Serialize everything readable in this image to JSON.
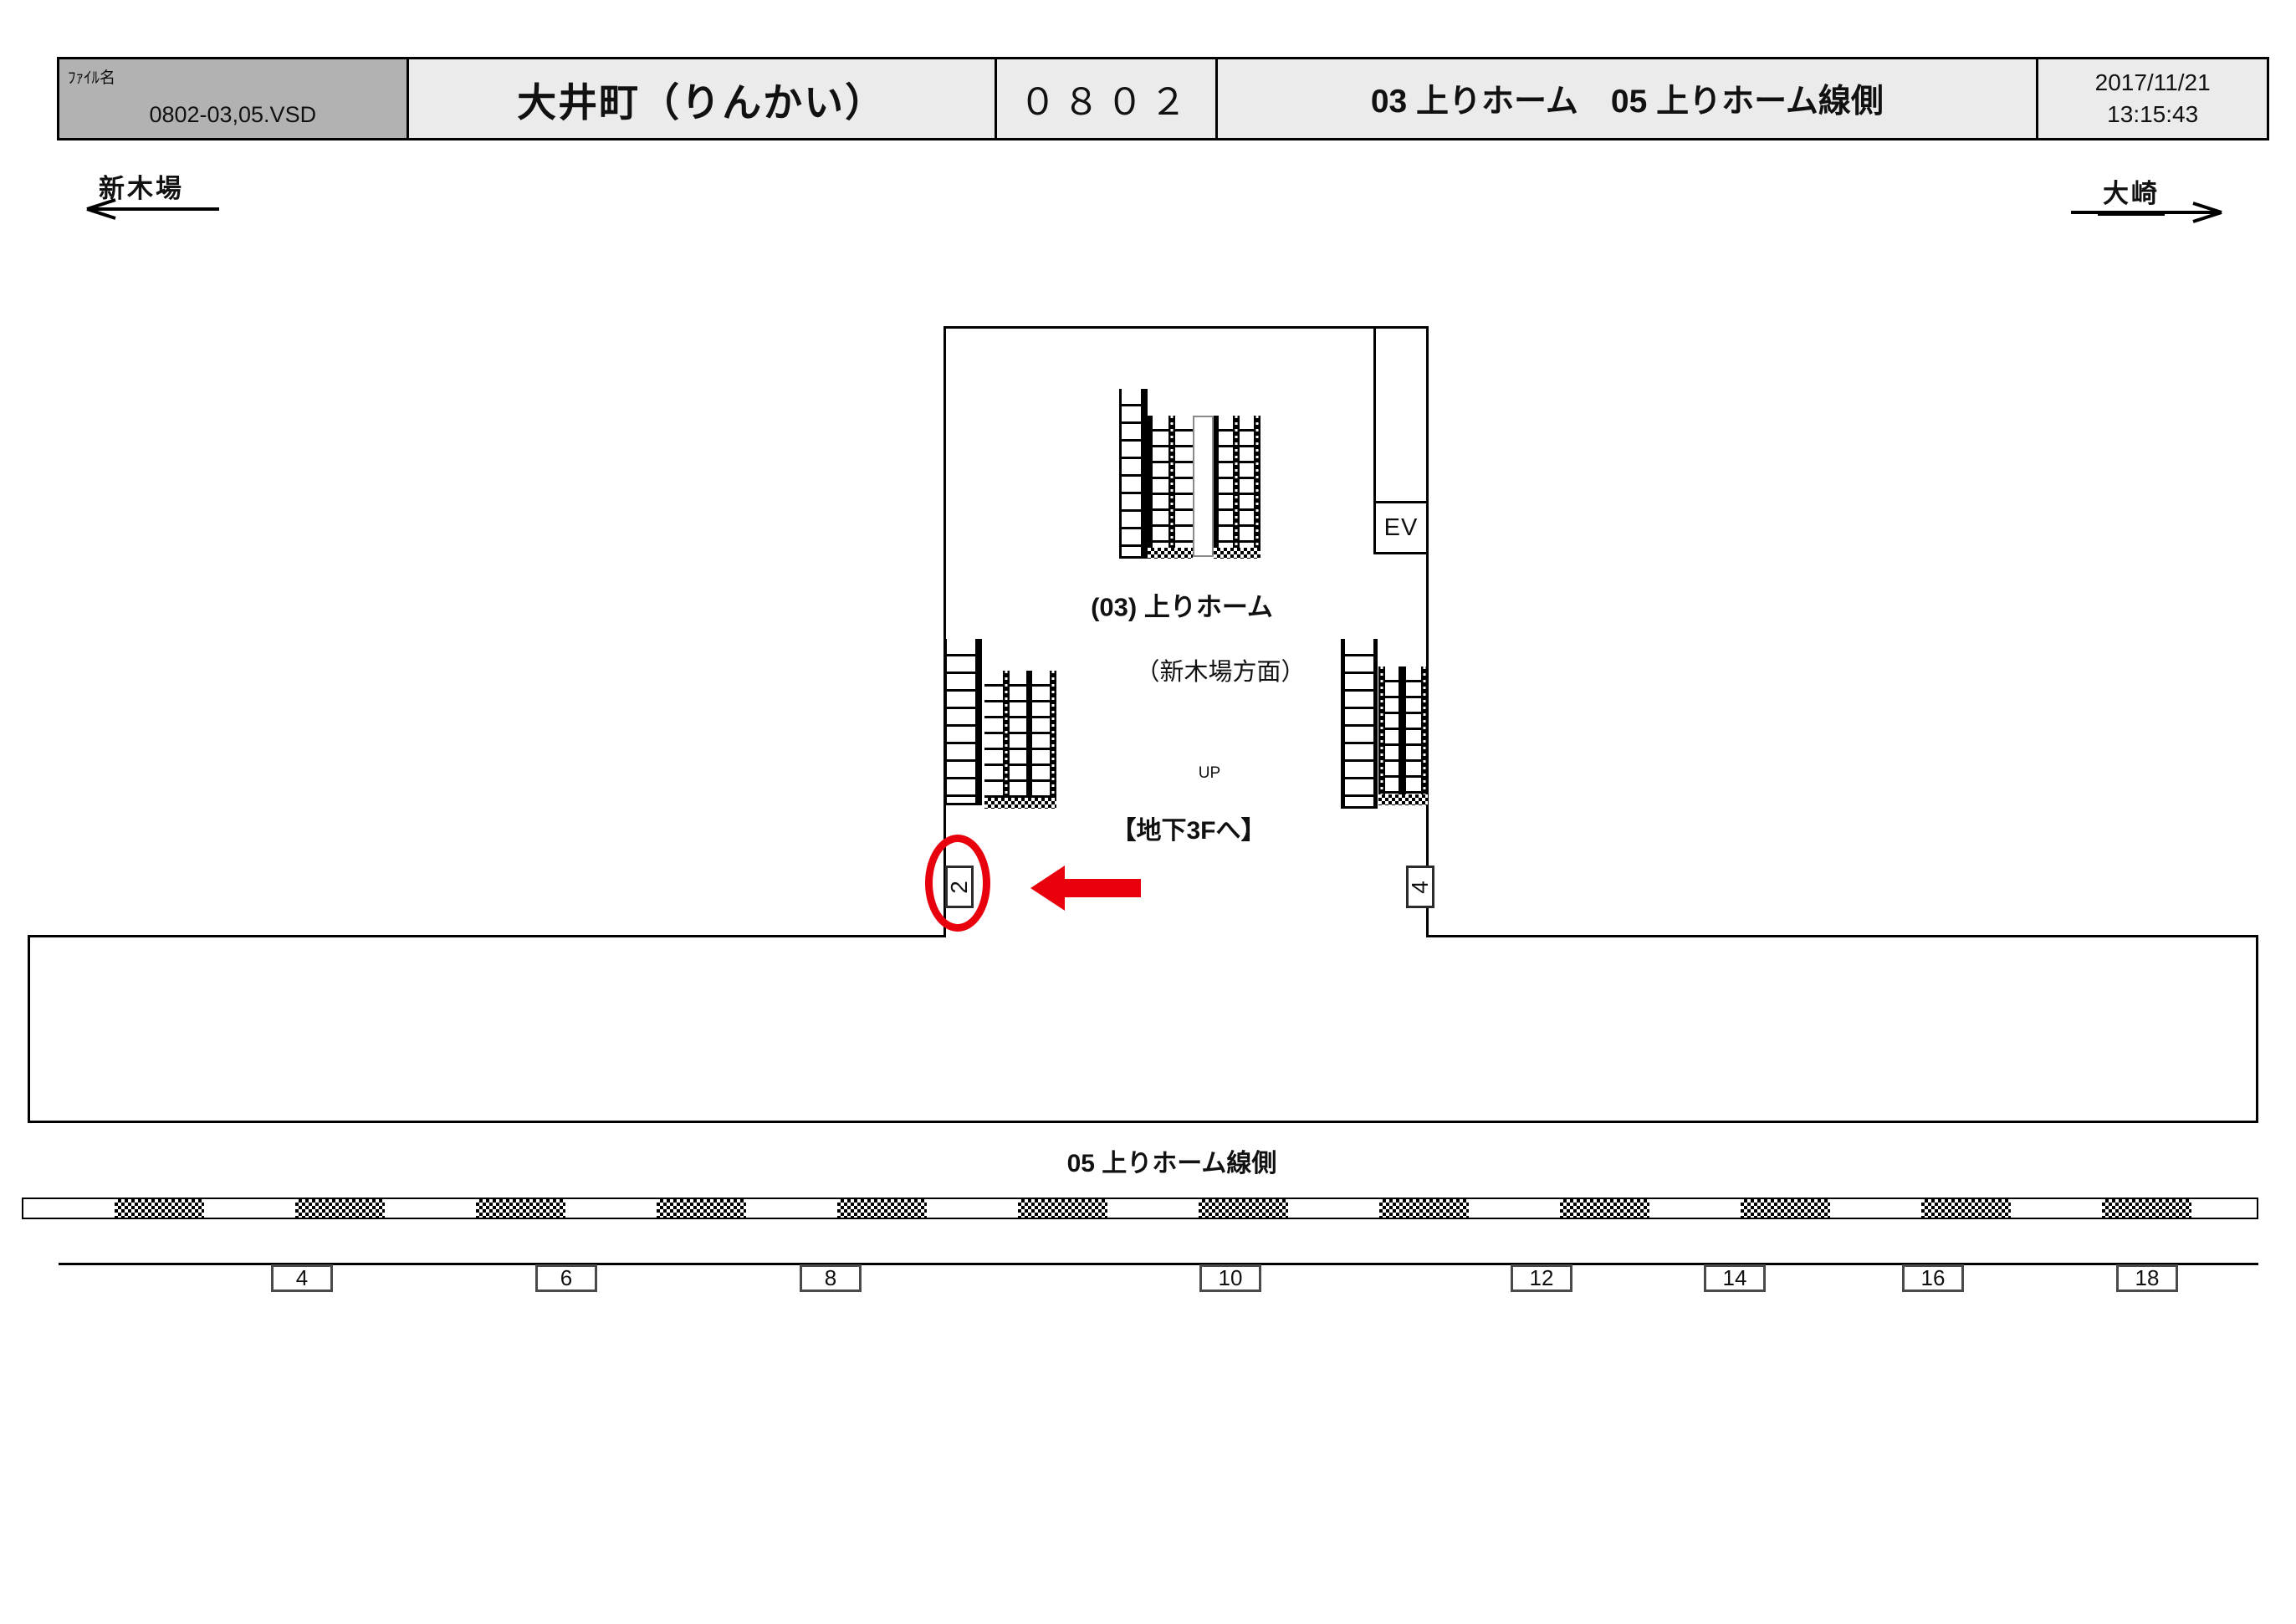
{
  "header": {
    "file_label": "ﾌｧｲﾙ名",
    "file_name": "0802-03,05.VSD",
    "station_name": "大井町（りんかい）",
    "station_code": "０８０２",
    "sheet_title": "03 上りホーム　05 上りホーム線側",
    "date": "2017/11/21",
    "time": "13:15:43"
  },
  "directions": {
    "left": "新木場",
    "right": "大崎"
  },
  "concourse": {
    "elevator": "EV",
    "floor_label": "(03) 上りホーム",
    "direction_note": "（新木場方面）",
    "up": "UP",
    "basement_note": "【地下3Fへ】",
    "left_position": "2",
    "right_position": "4"
  },
  "trackside": {
    "label": "05 上りホーム線側",
    "positions": [
      "4",
      "6",
      "8",
      "10",
      "12",
      "14",
      "16",
      "18"
    ]
  },
  "colors": {
    "highlight_red": "#e8000d",
    "header_grey": "#b2b2b2",
    "cell_grey": "#ebebeb"
  }
}
